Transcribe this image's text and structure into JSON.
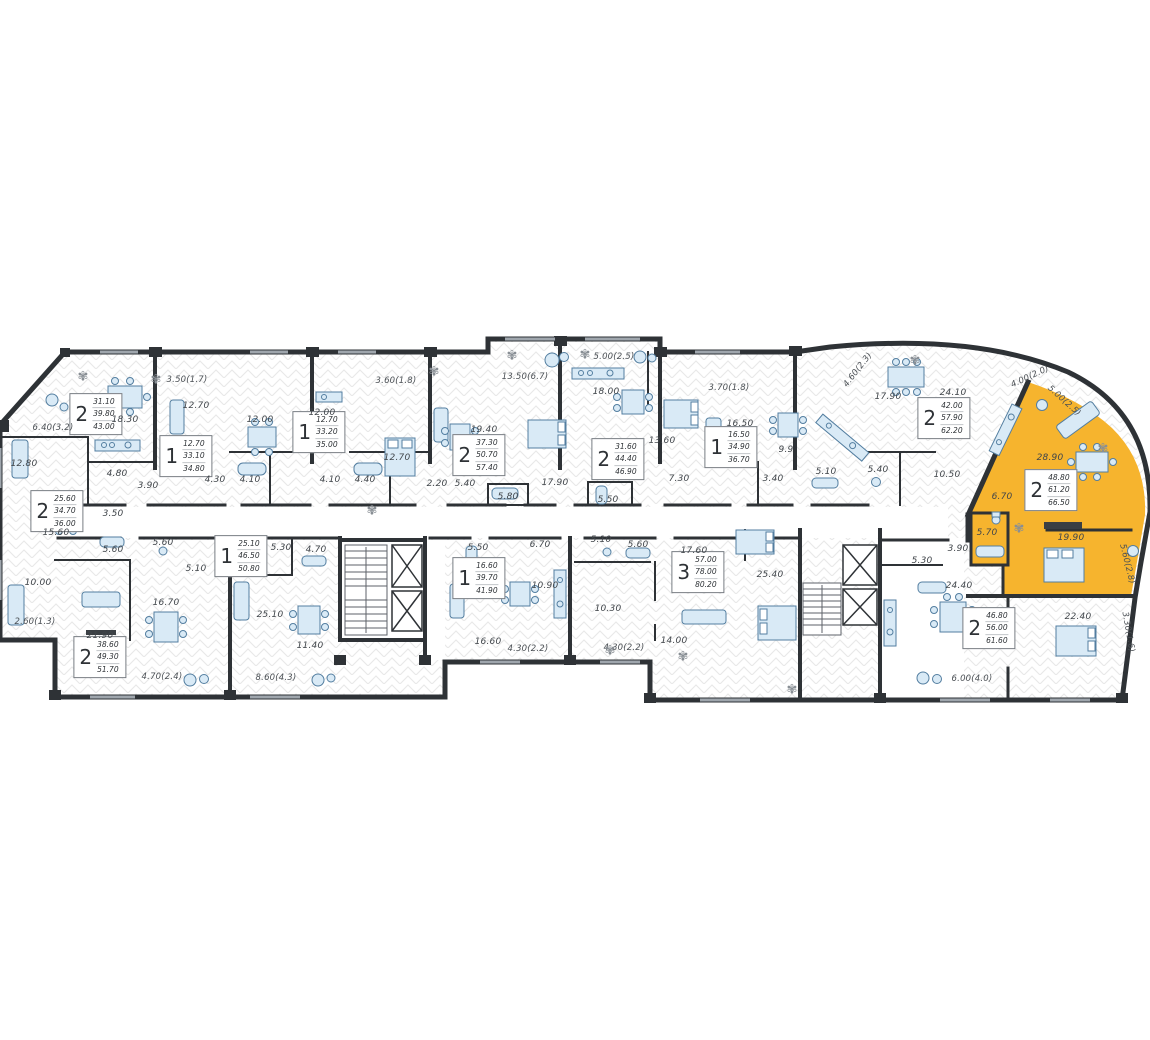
{
  "colors": {
    "highlight": "#F6B42E",
    "wall": "#2E3236",
    "furniture_fill": "#D9EAF6",
    "furniture_stroke": "#537EA0",
    "hatch": "#E4E4E4",
    "label_text": "#41464B"
  },
  "icons": {
    "plant": "✾"
  },
  "apartments": [
    {
      "unit": "a",
      "rooms": "2",
      "living": "31.10",
      "area": "39.80",
      "total": "43.00",
      "highlighted": false,
      "room_labels": [
        "18.30",
        "12.80",
        "4.80",
        "3.90"
      ],
      "balcony_labels": [
        "6.40(3.2)"
      ]
    },
    {
      "unit": "b",
      "rooms": "2",
      "living": "25.60",
      "area": "34.70",
      "total": "36.00",
      "highlighted": false,
      "room_labels": [
        "15.60",
        "10.00",
        "3.50",
        "5.60"
      ],
      "balcony_labels": [
        "2.60(1.3)"
      ]
    },
    {
      "unit": "c",
      "rooms": "1",
      "living": "12.70",
      "area": "33.10",
      "total": "34.80",
      "highlighted": false,
      "room_labels": [
        "12.70",
        "12.00",
        "4.30",
        "4.10"
      ],
      "balcony_labels": [
        "3.50(1.7)"
      ]
    },
    {
      "unit": "d",
      "rooms": "1",
      "living": "12.70",
      "area": "33.20",
      "total": "35.00",
      "highlighted": false,
      "room_labels": [
        "12.00",
        "12.70",
        "4.10",
        "4.40"
      ],
      "balcony_labels": [
        "3.60(1.8)"
      ]
    },
    {
      "unit": "e",
      "rooms": "2",
      "living": "37.30",
      "area": "50.70",
      "total": "57.40",
      "highlighted": false,
      "room_labels": [
        "19.40",
        "17.90",
        "5.40",
        "5.80",
        "2.20"
      ],
      "balcony_labels": [
        "13.50(6.7)"
      ]
    },
    {
      "unit": "f",
      "rooms": "2",
      "living": "31.60",
      "area": "44.40",
      "total": "46.90",
      "highlighted": false,
      "room_labels": [
        "18.00",
        "13.60",
        "5.50",
        "7.30"
      ],
      "balcony_labels": [
        "5.00(2.5)"
      ]
    },
    {
      "unit": "g",
      "rooms": "1",
      "living": "16.50",
      "area": "34.90",
      "total": "36.70",
      "highlighted": false,
      "room_labels": [
        "16.50",
        "9.9",
        "3.40",
        "5.10"
      ],
      "balcony_labels": [
        "3.70(1.8)"
      ]
    },
    {
      "unit": "h",
      "rooms": "2",
      "living": "42.00",
      "area": "57.90",
      "total": "62.20",
      "highlighted": false,
      "room_labels": [
        "17.90",
        "24.10",
        "5.40",
        "10.50"
      ],
      "balcony_labels": [
        "4.60(2.3)",
        "4.00(2.0)"
      ]
    },
    {
      "unit": "i",
      "rooms": "2",
      "living": "48.80",
      "area": "61.20",
      "total": "66.50",
      "highlighted": true,
      "room_labels": [
        "28.90",
        "6.70",
        "5.70",
        "19.90"
      ],
      "balcony_labels": [
        "5.00(2.5)",
        "5.60(2.8)"
      ]
    },
    {
      "unit": "j",
      "rooms": "2",
      "living": "38.60",
      "area": "49.30",
      "total": "51.70",
      "highlighted": false,
      "room_labels": [
        "21.90",
        "16.70",
        "5.60",
        "5.10"
      ],
      "balcony_labels": [
        "4.70(2.4)"
      ]
    },
    {
      "unit": "k",
      "rooms": "1",
      "living": "25.10",
      "area": "46.50",
      "total": "50.80",
      "highlighted": false,
      "room_labels": [
        "25.10",
        "5.30",
        "4.70",
        "11.40"
      ],
      "balcony_labels": [
        "8.60(4.3)"
      ]
    },
    {
      "unit": "l",
      "rooms": "1",
      "living": "16.60",
      "area": "39.70",
      "total": "41.90",
      "highlighted": false,
      "room_labels": [
        "16.60",
        "10.90",
        "6.70",
        "5.50"
      ],
      "balcony_labels": [
        "4.30(2.2)"
      ]
    },
    {
      "unit": "m",
      "rooms": "3",
      "living": "57.00",
      "area": "78.00",
      "total": "80.20",
      "highlighted": false,
      "room_labels": [
        "17.60",
        "25.40",
        "14.00",
        "10.30",
        "5.60",
        "5.10"
      ],
      "balcony_labels": [
        "4.30(2.2)"
      ]
    },
    {
      "unit": "n",
      "rooms": "2",
      "living": "46.80",
      "area": "56.00",
      "total": "61.60",
      "highlighted": false,
      "room_labels": [
        "24.40",
        "22.40",
        "5.30",
        "3.90"
      ],
      "balcony_labels": [
        "6.00(4.0)",
        "3.30(1.6)"
      ]
    }
  ]
}
